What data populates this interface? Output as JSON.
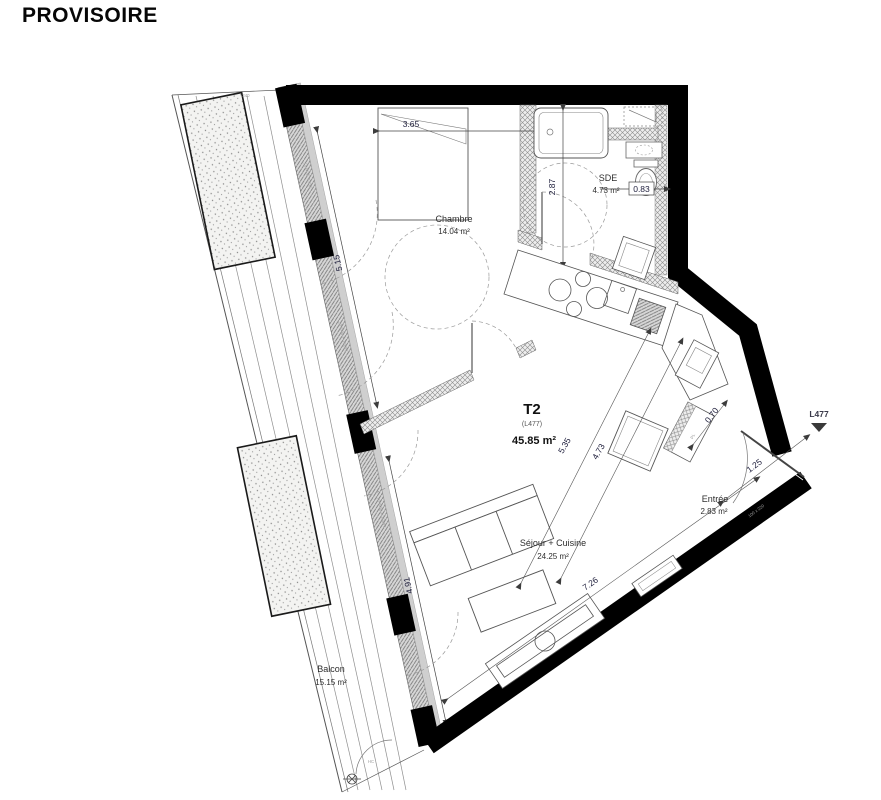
{
  "watermark": "PROVISOIRE",
  "unit": {
    "type": "T2",
    "lot": "(L477)",
    "area": "45.85 m²"
  },
  "marker": {
    "label": "L477"
  },
  "rooms": {
    "chambre": {
      "name": "Chambre",
      "area": "14.04 m²"
    },
    "sde": {
      "name": "SDE",
      "area": "4.73 m²"
    },
    "sejour": {
      "name": "Séjour + Cuisine",
      "area": "24.25 m²"
    },
    "entree": {
      "name": "Entrée",
      "area": "2.83 m²"
    },
    "balcon": {
      "name": "Balcon",
      "area": "15.15 m²"
    }
  },
  "dimensions": {
    "bed_width": "3.65",
    "sde_depth": "2.87",
    "sde_clear": "0.83",
    "window_left_upper": "5.15",
    "window_left_lower": "4.91",
    "living_width": "5.35",
    "living_depth": "4.73",
    "hall_clear": "0.70",
    "entry_door": "1.25",
    "living_length": "7.26"
  },
  "annotations": {
    "planter": "240",
    "closet": "PL",
    "drain": "HC",
    "door_spec": "100 x 220",
    "window_spec_1": "VOUL 2cm 17",
    "window_spec_2": "140SL + 2cm 07",
    "window_spec_3": "140SL + 2cm 07"
  },
  "colors": {
    "wall": "#000000",
    "line": "#555555",
    "dim_text": "#1c1c3a",
    "label_text": "#2e2e2e"
  }
}
